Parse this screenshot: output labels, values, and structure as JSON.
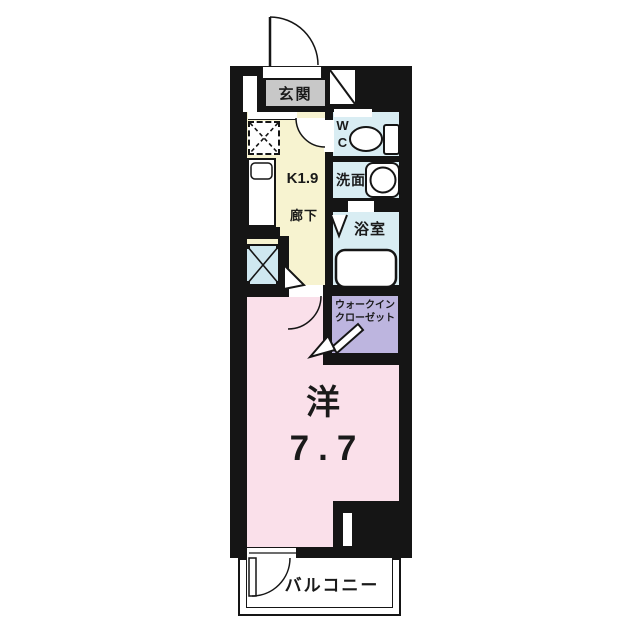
{
  "floor_plan": {
    "rooms": {
      "entrance": {
        "label": "玄関"
      },
      "kitchen": {
        "label": "K1.9"
      },
      "corridor": {
        "label": "廊下"
      },
      "wc": {
        "label_line1": "W",
        "label_line2": "C"
      },
      "washroom": {
        "label": "洗面"
      },
      "bathroom": {
        "label": "浴室"
      },
      "walk_in_closet": {
        "label_line1": "ウォークイン",
        "label_line2": "クローゼット"
      },
      "western_room": {
        "type_label": "洋",
        "size_label": "7.7"
      },
      "balcony": {
        "label": "バルコニー"
      }
    },
    "fixtures": [
      "entrance-door",
      "shoe-cabinet",
      "refrigerator-space",
      "kitchen-sink",
      "washer-pan",
      "toilet",
      "wash-basin",
      "bathtub",
      "folding-door",
      "interior-door",
      "closet-door",
      "balcony-door",
      "window-slit"
    ],
    "colors": {
      "wall": "#151515",
      "entrance": "#c8c8c8",
      "kitchen_corridor": "#f7f3d0",
      "wet_area": "#d9edf3",
      "washer_pan": "#cfe8f0",
      "closet": "#bdb5df",
      "room": "#fae0ea",
      "balcony": "#ffffff"
    }
  }
}
